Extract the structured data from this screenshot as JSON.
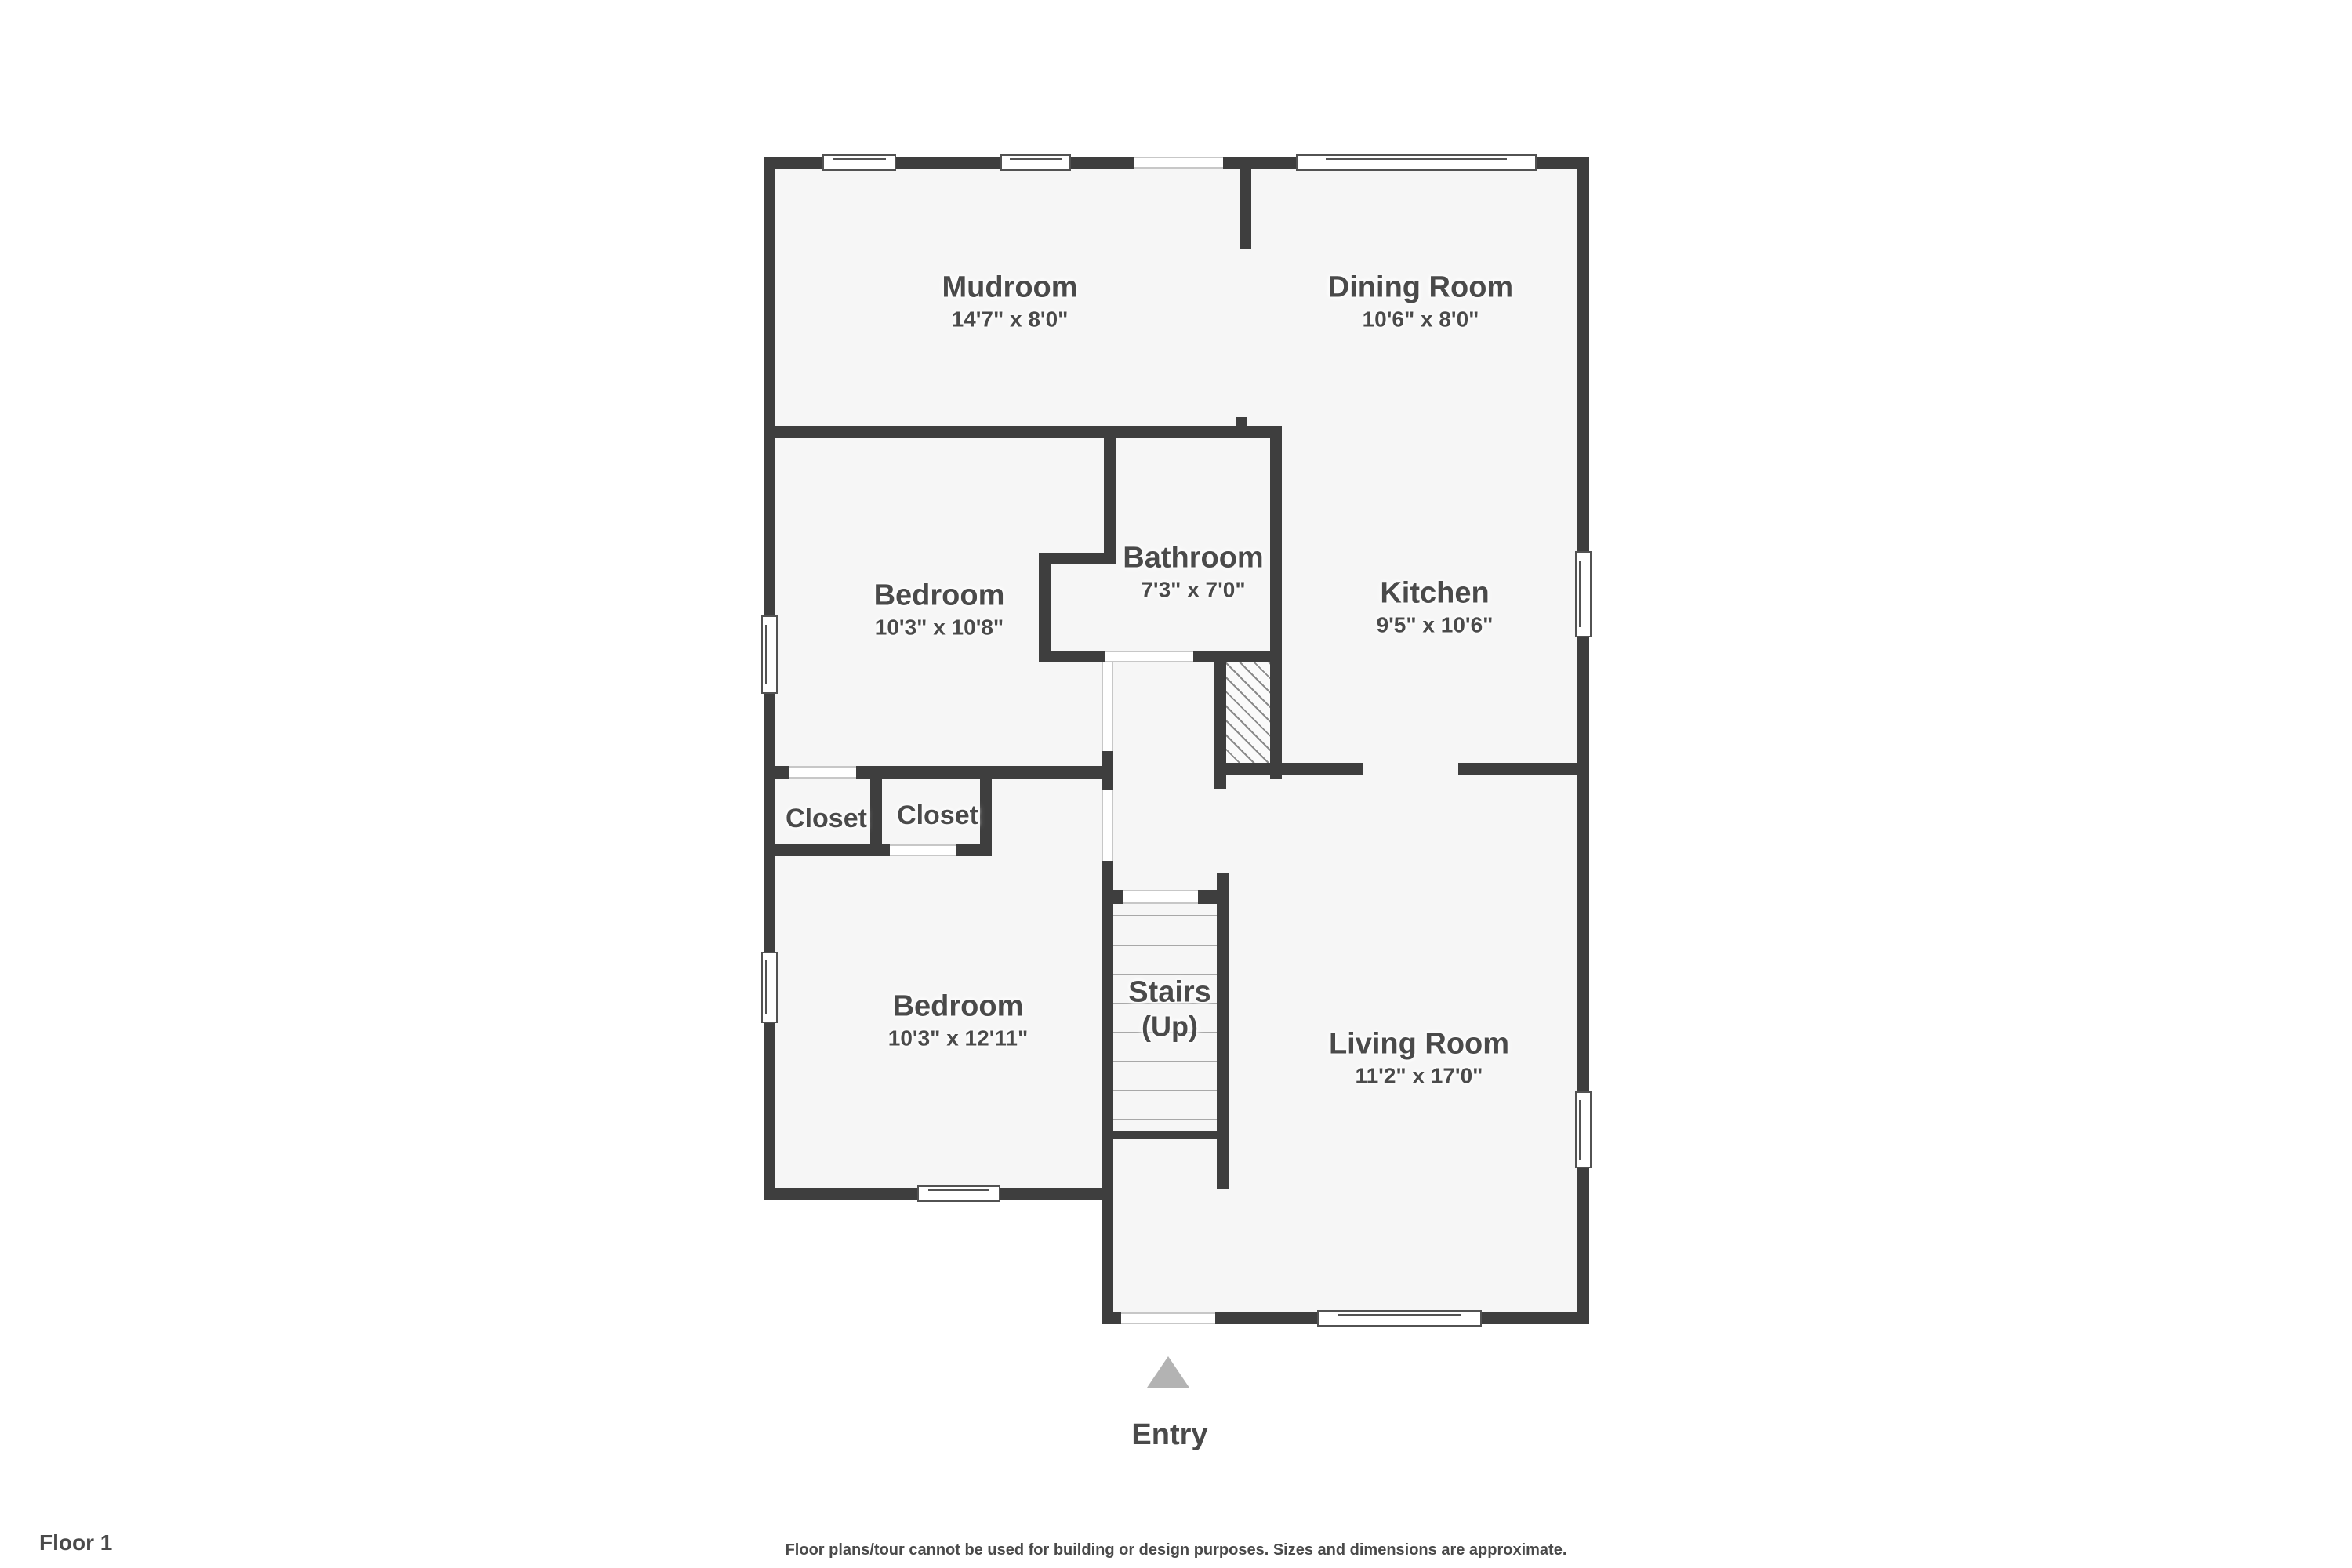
{
  "rooms": {
    "mudroom": {
      "name": "Mudroom",
      "dims": "14'7\" x 8'0\""
    },
    "dining": {
      "name": "Dining Room",
      "dims": "10'6\" x 8'0\""
    },
    "bedroom1": {
      "name": "Bedroom",
      "dims": "10'3\" x 10'8\""
    },
    "bathroom": {
      "name": "Bathroom",
      "dims": "7'3\" x 7'0\""
    },
    "kitchen": {
      "name": "Kitchen",
      "dims": "9'5\" x 10'6\""
    },
    "closet_left": {
      "name": "Closet"
    },
    "closet_right": {
      "name": "Closet"
    },
    "bedroom2": {
      "name": "Bedroom",
      "dims": "10'3\" x 12'11\""
    },
    "stairs": {
      "name": "Stairs",
      "sub": "(Up)"
    },
    "living": {
      "name": "Living Room",
      "dims": "11'2\" x 17'0\""
    }
  },
  "entry": {
    "label": "Entry"
  },
  "footer": {
    "floor_label": "Floor 1",
    "disclaimer": "Floor plans/tour cannot be used for building or design purposes. Sizes and dimensions are approximate."
  },
  "colors": {
    "wall": "#3e3e3e",
    "floor": "#f6f6f6",
    "text": "#4a4a4a",
    "entry_arrow": "#b3b3b3"
  }
}
